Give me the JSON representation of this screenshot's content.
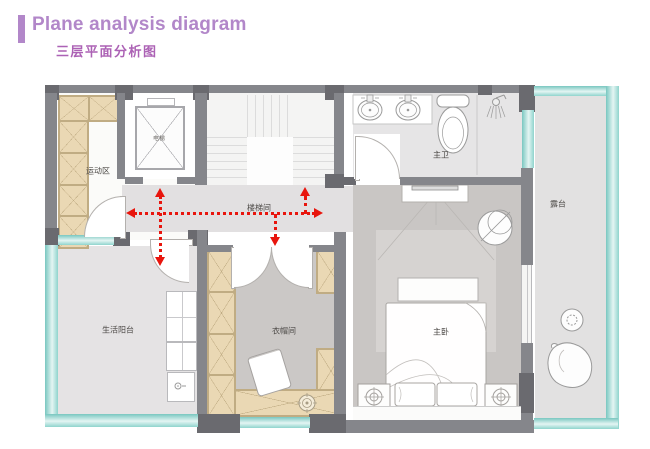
{
  "header": {
    "title_en": "Plane analysis diagram",
    "title_zh": "三层平面分析图"
  },
  "plan": {
    "rooms": {
      "activity_area": {
        "label": "运动区"
      },
      "elevator": {
        "label": "电梯"
      },
      "stairwell": {
        "label": "楼梯间"
      },
      "master_bath": {
        "label": "主卫"
      },
      "terrace": {
        "label": "露台"
      },
      "living_balcony": {
        "label": "生活阳台"
      },
      "cloakroom": {
        "label": "衣帽间"
      },
      "master_bedroom": {
        "label": "主卧"
      }
    }
  },
  "colors": {
    "accent_purple": "#b287c9",
    "subtitle_purple": "#ac62b5",
    "wall_gray": "#85868b",
    "pier_gray": "#6a6a6f",
    "cabinet_tan": "#ead8b4",
    "cabinet_line": "#c0ac83",
    "glass_teal": "#8fd4cd",
    "arrow_red": "#e8150d"
  }
}
